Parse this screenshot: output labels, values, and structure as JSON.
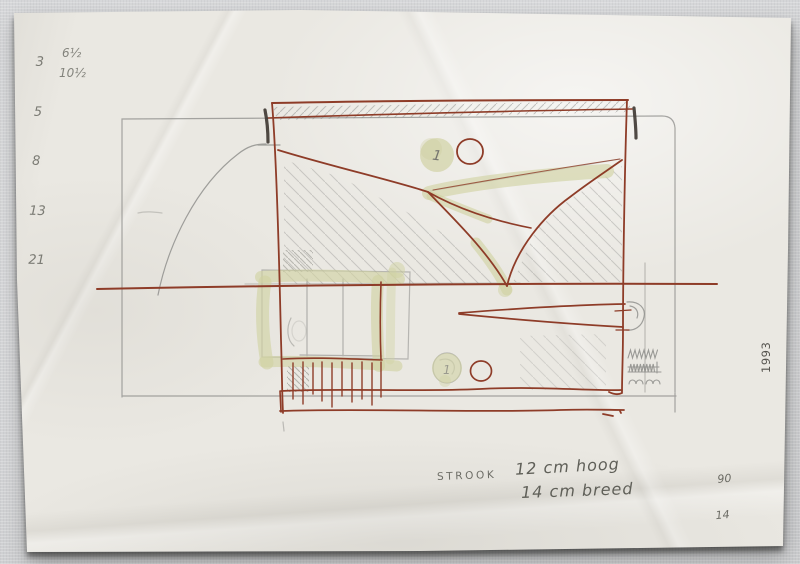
{
  "annotations": {
    "number_column": [
      "3",
      "5",
      "8",
      "13",
      "21"
    ],
    "fraction_notes": [
      "6½",
      "10½"
    ],
    "strook_label": "STROOK",
    "dimension_height": "12 cm hoog",
    "dimension_width": "14 cm breed",
    "ratio_numerator": "90",
    "ratio_denominator": "14",
    "year": "1993",
    "blob_mark_top": "1",
    "blob_mark_bottom": "1"
  },
  "colors": {
    "ink_red": "#8e3c28",
    "pencil_gray": "#8b8b88",
    "highlighter_olive": "#d0d2a2",
    "heavy_mark": "#3d3631",
    "paper": "#eae8e2",
    "wall": "#d3d4d6"
  }
}
